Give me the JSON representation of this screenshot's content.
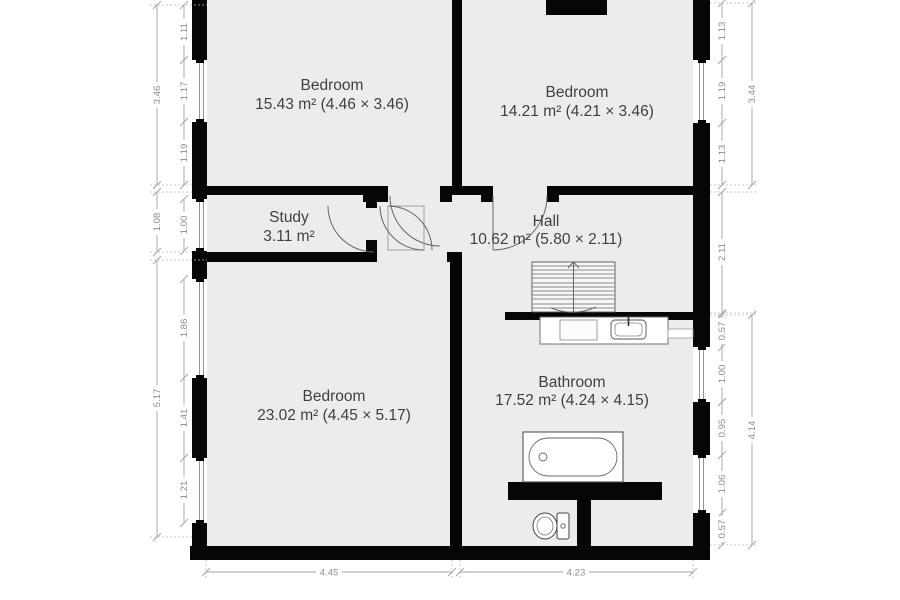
{
  "title": "Floor plan",
  "colors": {
    "wall": "#060606",
    "floor": "#ececec",
    "label": "#3e4044",
    "dimension": "#8d8d8d"
  },
  "rooms": [
    {
      "id": "bedroom-top-left",
      "name": "Bedroom",
      "area": "15.43 m² (4.46 × 3.46)"
    },
    {
      "id": "bedroom-top-right",
      "name": "Bedroom",
      "area": "14.21 m² (4.21 × 3.46)"
    },
    {
      "id": "study",
      "name": "Study",
      "area": "3.11 m²"
    },
    {
      "id": "hall",
      "name": "Hall",
      "area": "10.62 m² (5.80 × 2.11)"
    },
    {
      "id": "bedroom-bottom",
      "name": "Bedroom",
      "area": "23.02 m² (4.45 × 5.17)"
    },
    {
      "id": "bathroom",
      "name": "Bathroom",
      "area": "17.52 m² (4.24 × 4.15)"
    }
  ],
  "fixtures": [
    "staircase",
    "bathtub",
    "toilet",
    "sink-vanity"
  ],
  "dims": {
    "left_outer": [
      "3.46",
      "1.08",
      "5.17"
    ],
    "left_inner": [
      "1.11",
      "1.17",
      "1.19",
      "1.00",
      "1.86",
      "1.41",
      "1.21"
    ],
    "right_inner": [
      "1.13",
      "1.19",
      "1.13",
      "2.11",
      "0.57",
      "1.00",
      "0.95",
      "1.06",
      "0.57"
    ],
    "right_outer": [
      "3.44",
      "4.14"
    ],
    "bottom": [
      "4.45",
      "4.23"
    ]
  }
}
